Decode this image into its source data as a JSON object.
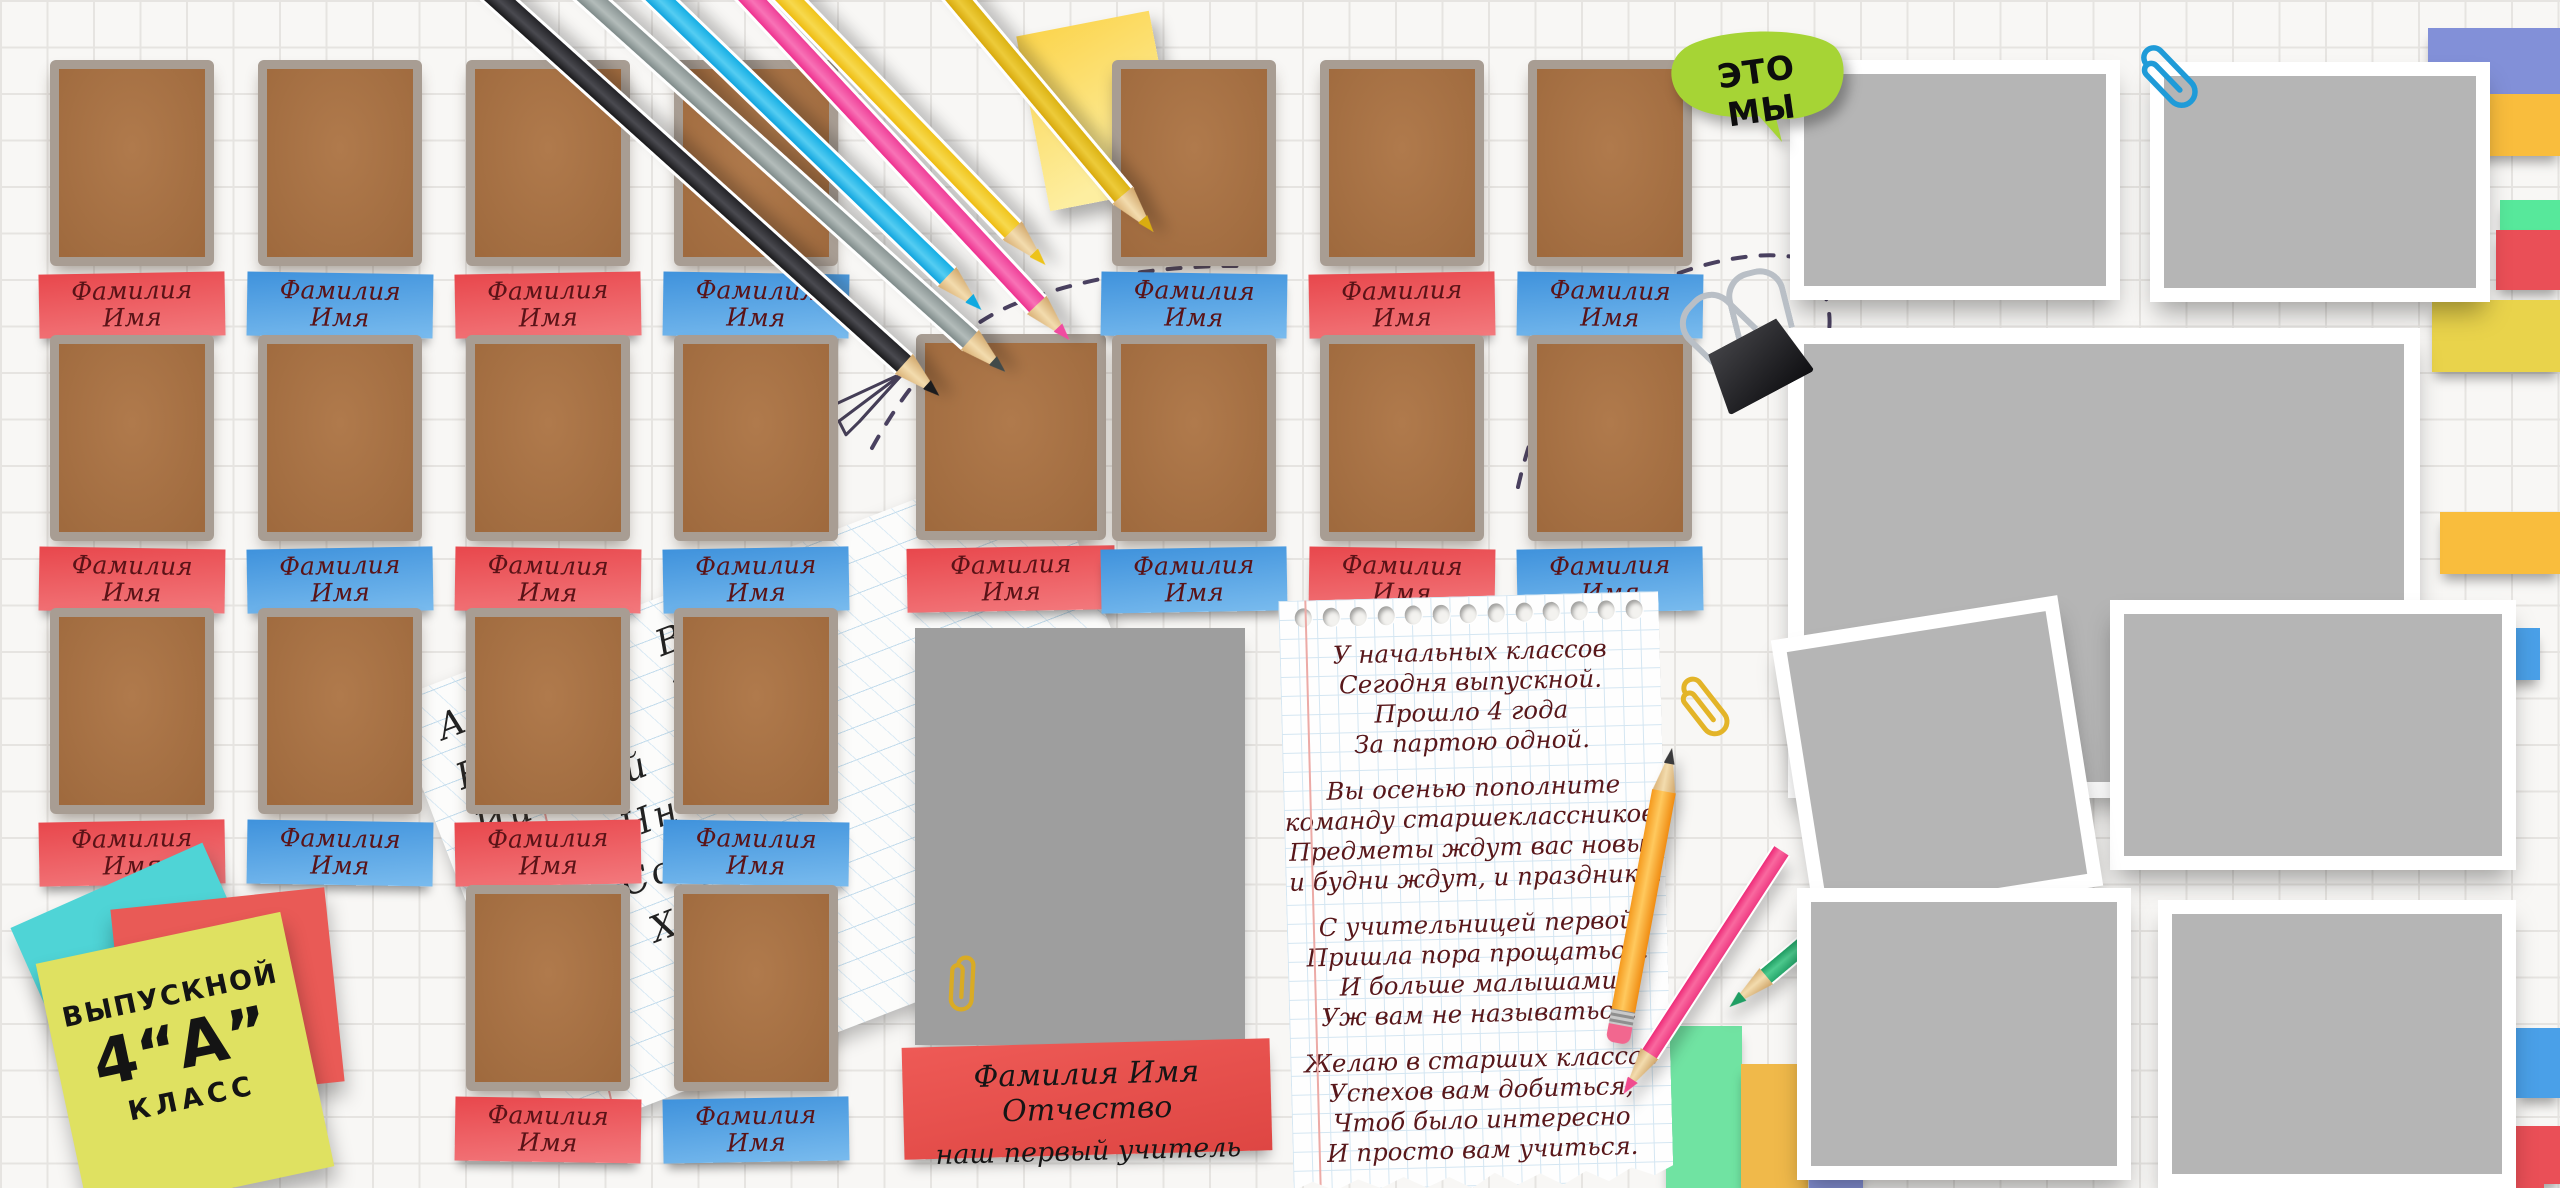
{
  "bubble": {
    "text": "ЭТО МЫ"
  },
  "name_tag": {
    "surname": "Фамилия",
    "name": "Имя"
  },
  "teacher_card": {
    "line1": "Фамилия Имя Отчество",
    "line2": "наш первый учитель"
  },
  "class_sticker": {
    "line1": "ВЫПУСКНОЙ",
    "line2": "4“А”",
    "line3": "КЛАСС"
  },
  "poem": {
    "stanzas": [
      [
        "У начальных классов",
        "Сегодня выпускной.",
        "Прошло 4 года",
        "За партою одной."
      ],
      [
        "Вы осенью пополните",
        "команду старшеклассников.",
        "Предметы ждут вас новые",
        "и будни ждут, и праздники."
      ],
      [
        "С учительницей первой",
        "Пришла пора прощаться.",
        "И больше малышами",
        "Уж вам не называться."
      ],
      [
        "Желаю в старших классах",
        "Успехов вам добиться,",
        "Чтоб было интересно",
        "И просто вам учиться."
      ]
    ]
  },
  "alphabet_sheet": {
    "rows": [
      "Аа Бб Вв Зз",
      "Ее Ёё Жж",
      "Ии Йй Лл",
      "Мм Нн",
      "Рр Сс",
      "Фф Хх",
      "Шш Щщ",
      "Ээ Юю"
    ]
  },
  "icons": {
    "paperclip_yellow": "paperclip-icon",
    "paperclip_blue": "paperclip-icon",
    "binder_clip": "binder-clip-icon",
    "paper_plane": "paper-plane-icon",
    "speech_bubble": "speech-bubble-icon"
  },
  "colors": {
    "tag_red": "#e8474c",
    "tag_blue": "#4f9ddf",
    "photo_brown": "#a97045",
    "frame_gray": "#a89d93",
    "polaroid_gray": "#b5b5b5",
    "bubble_green": "#a6d435",
    "sticky_yellow": "#fbd44c",
    "note_lime": "#dfe161",
    "note_cyan": "#4fd4d6",
    "note_red": "#e95a56",
    "teacher_card_red": "#e8504d"
  }
}
